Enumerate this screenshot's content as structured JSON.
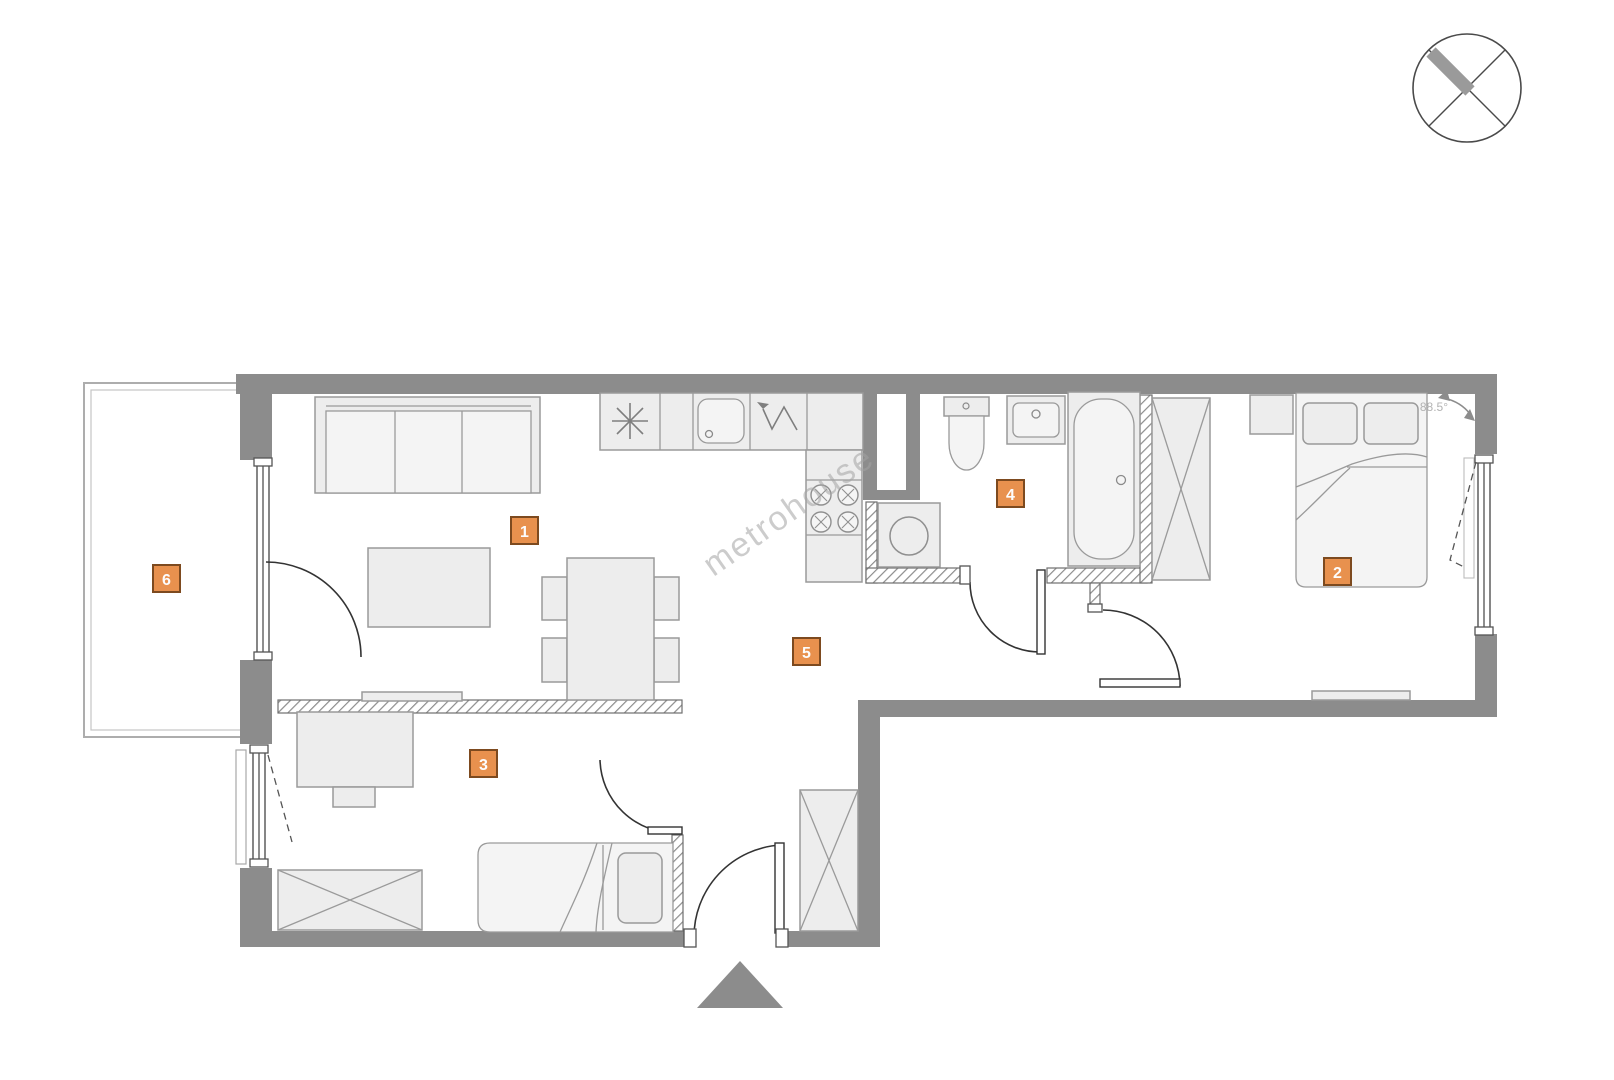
{
  "plan": {
    "watermark": "metrohouse",
    "angle_label": "88.5°",
    "rooms": [
      {
        "number": "1"
      },
      {
        "number": "2"
      },
      {
        "number": "3"
      },
      {
        "number": "4"
      },
      {
        "number": "5"
      },
      {
        "number": "6"
      }
    ]
  },
  "colors": {
    "badge_fill": "#e8914e",
    "badge_border": "#7d4a1f",
    "badge_text": "#ffffff",
    "wall": "#8c8c8c",
    "furniture_fill": "#ededed",
    "line": "#9a9a9a",
    "watermark": "#a3a3a3",
    "background": "#ffffff"
  }
}
